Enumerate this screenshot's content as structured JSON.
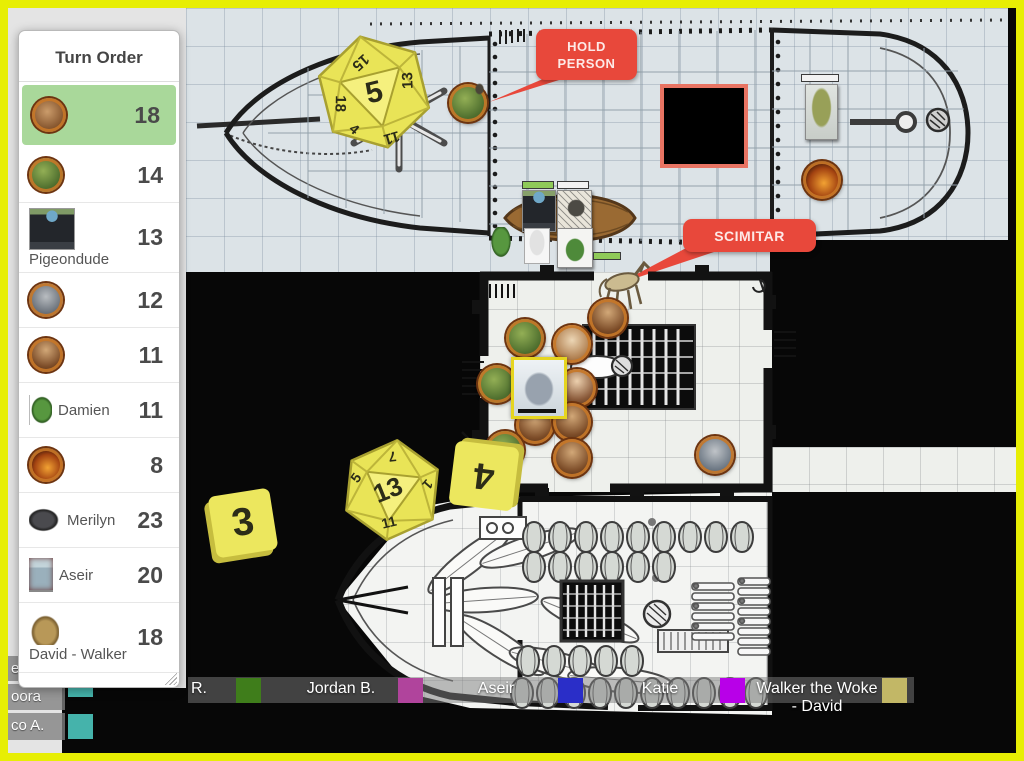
{
  "turn_order": {
    "title": "Turn Order",
    "items": [
      {
        "name": "",
        "value": "18",
        "avatar": "a-boar a-round",
        "layout": "plain",
        "active": true
      },
      {
        "name": "",
        "value": "14",
        "avatar": "a-lizard a-round",
        "layout": "plain",
        "active": false
      },
      {
        "name": "Pigeondude",
        "value": "13",
        "avatar": "a-suit",
        "layout": "below",
        "active": false
      },
      {
        "name": "",
        "value": "12",
        "avatar": "a-gray a-round",
        "layout": "plain",
        "active": false
      },
      {
        "name": "",
        "value": "11",
        "avatar": "a-dwarf a-round",
        "layout": "plain",
        "active": false
      },
      {
        "name": "Damien",
        "value": "11",
        "avatar": "a-damien",
        "layout": "inline",
        "active": false
      },
      {
        "name": "",
        "value": "8",
        "avatar": "a-fire a-round",
        "layout": "plain",
        "active": false
      },
      {
        "name": "Merilyn",
        "value": "23",
        "avatar": "a-merilyn",
        "layout": "inline",
        "active": false
      },
      {
        "name": "Aseir",
        "value": "20",
        "avatar": "a-aseir",
        "layout": "inline",
        "active": false
      },
      {
        "name": "David - Walker",
        "value": "18",
        "avatar": "a-camel",
        "layout": "below",
        "active": false
      }
    ]
  },
  "map": {
    "callouts": [
      {
        "text": "HOLD PERSON"
      },
      {
        "text": "SCIMITAR"
      }
    ],
    "dice": [
      {
        "type": "d20",
        "result": "5",
        "adjacent": [
          "15",
          "18",
          "13",
          "11",
          "4"
        ]
      },
      {
        "type": "d20",
        "result": "13",
        "adjacent": [
          "5",
          "1",
          "11",
          "7"
        ]
      },
      {
        "type": "tile",
        "result": "4"
      },
      {
        "type": "tile",
        "result": "3"
      }
    ],
    "colors": {
      "die_yellow": "#ece75e",
      "callout_red": "#e8483b",
      "fog_square_border": "#e87463",
      "active_turn_green": "#a9d89a",
      "page_border_yellow": "#e7ee04"
    }
  },
  "players_bar": [
    {
      "name": "R.",
      "color": "#3f7d1b"
    },
    {
      "name": "Jordan B.",
      "color": "#b0449c"
    },
    {
      "name": "Aseir",
      "color": "#2a2ec8"
    },
    {
      "name": "Katie",
      "color": "#b800e8"
    },
    {
      "name": "Walker the Woke - David",
      "color": "#c2b766"
    }
  ],
  "left_players": [
    {
      "name": "ed",
      "color": ""
    },
    {
      "name": "oora",
      "color": "#45b3ab"
    },
    {
      "name": "co A.",
      "color": "#45b3ab"
    }
  ]
}
